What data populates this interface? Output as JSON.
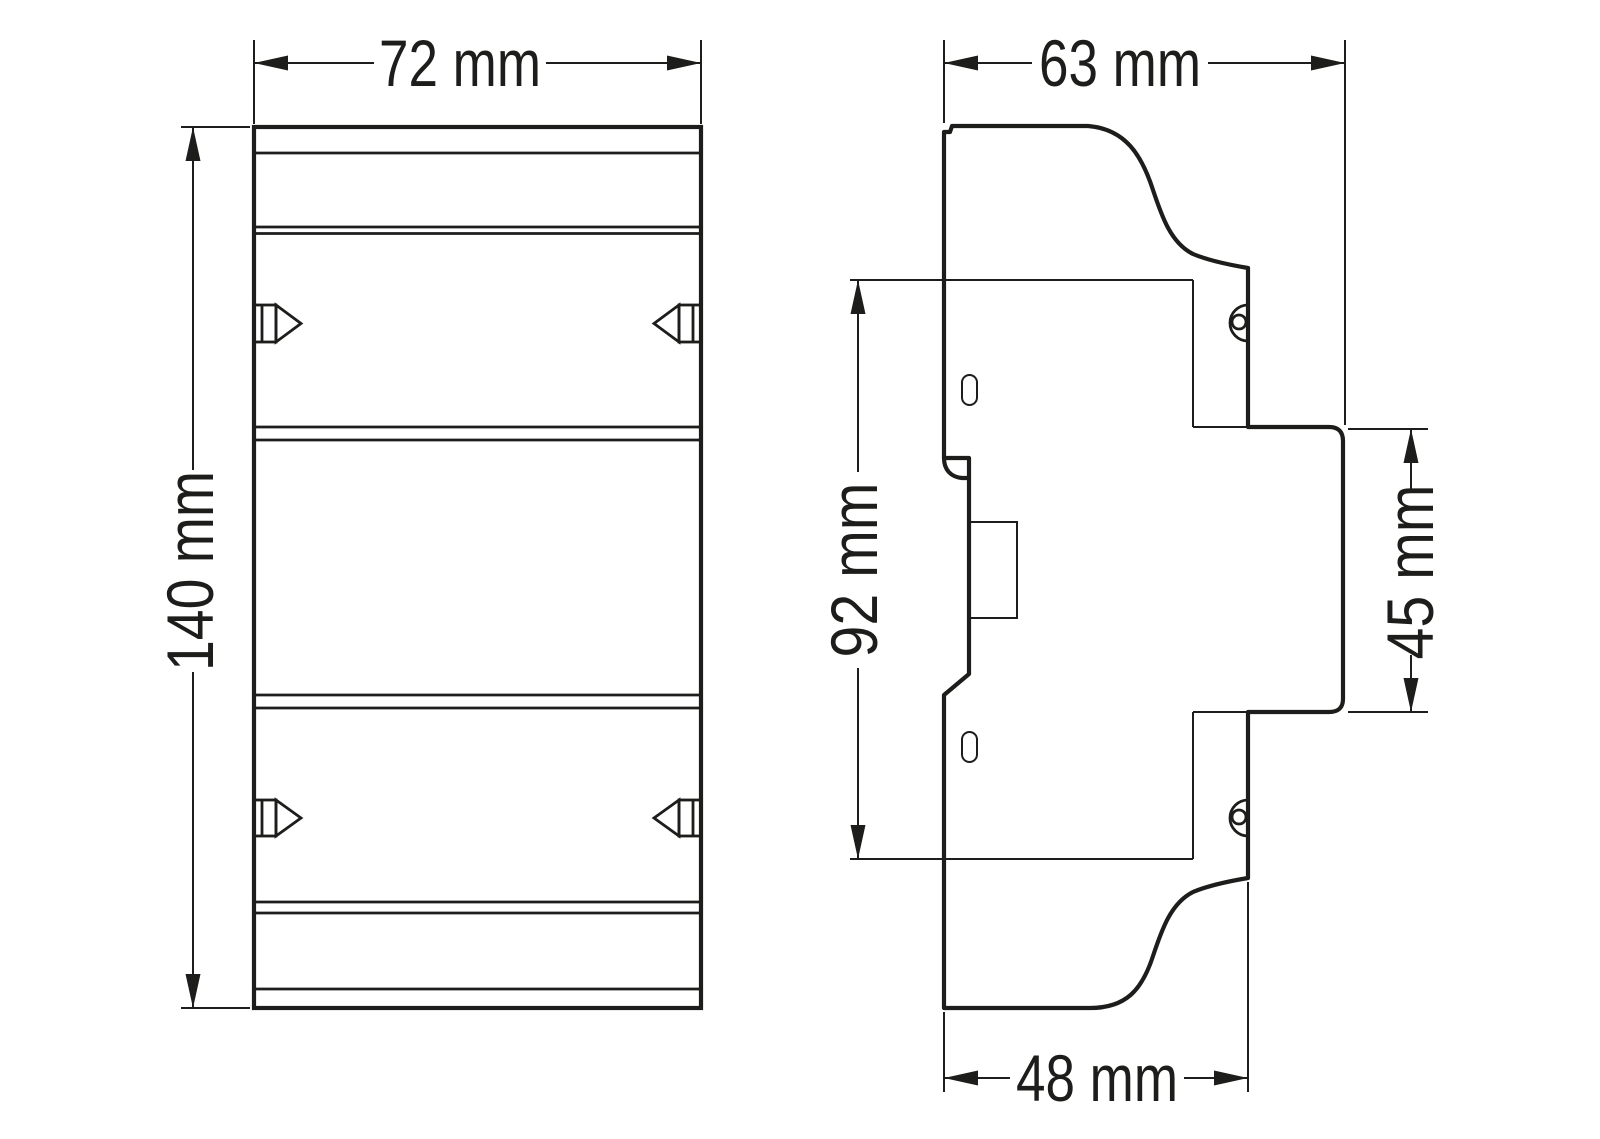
{
  "drawing": {
    "type": "dimensional technical drawing",
    "views": {
      "front": {
        "width": {
          "label": "72 mm",
          "value": 72,
          "unit": "mm"
        },
        "height": {
          "label": "140 mm",
          "value": 140,
          "unit": "mm"
        }
      },
      "side": {
        "total_depth": {
          "label": "63 mm",
          "value": 63,
          "unit": "mm"
        },
        "body_height": {
          "label": "92 mm",
          "value": 92,
          "unit": "mm"
        },
        "front_section": {
          "label": "45 mm",
          "value": 45,
          "unit": "mm"
        },
        "rail_depth": {
          "label": "48 mm",
          "value": 48,
          "unit": "mm"
        }
      }
    },
    "style": {
      "line_color": "#1d1d1b",
      "background": "#ffffff"
    }
  }
}
